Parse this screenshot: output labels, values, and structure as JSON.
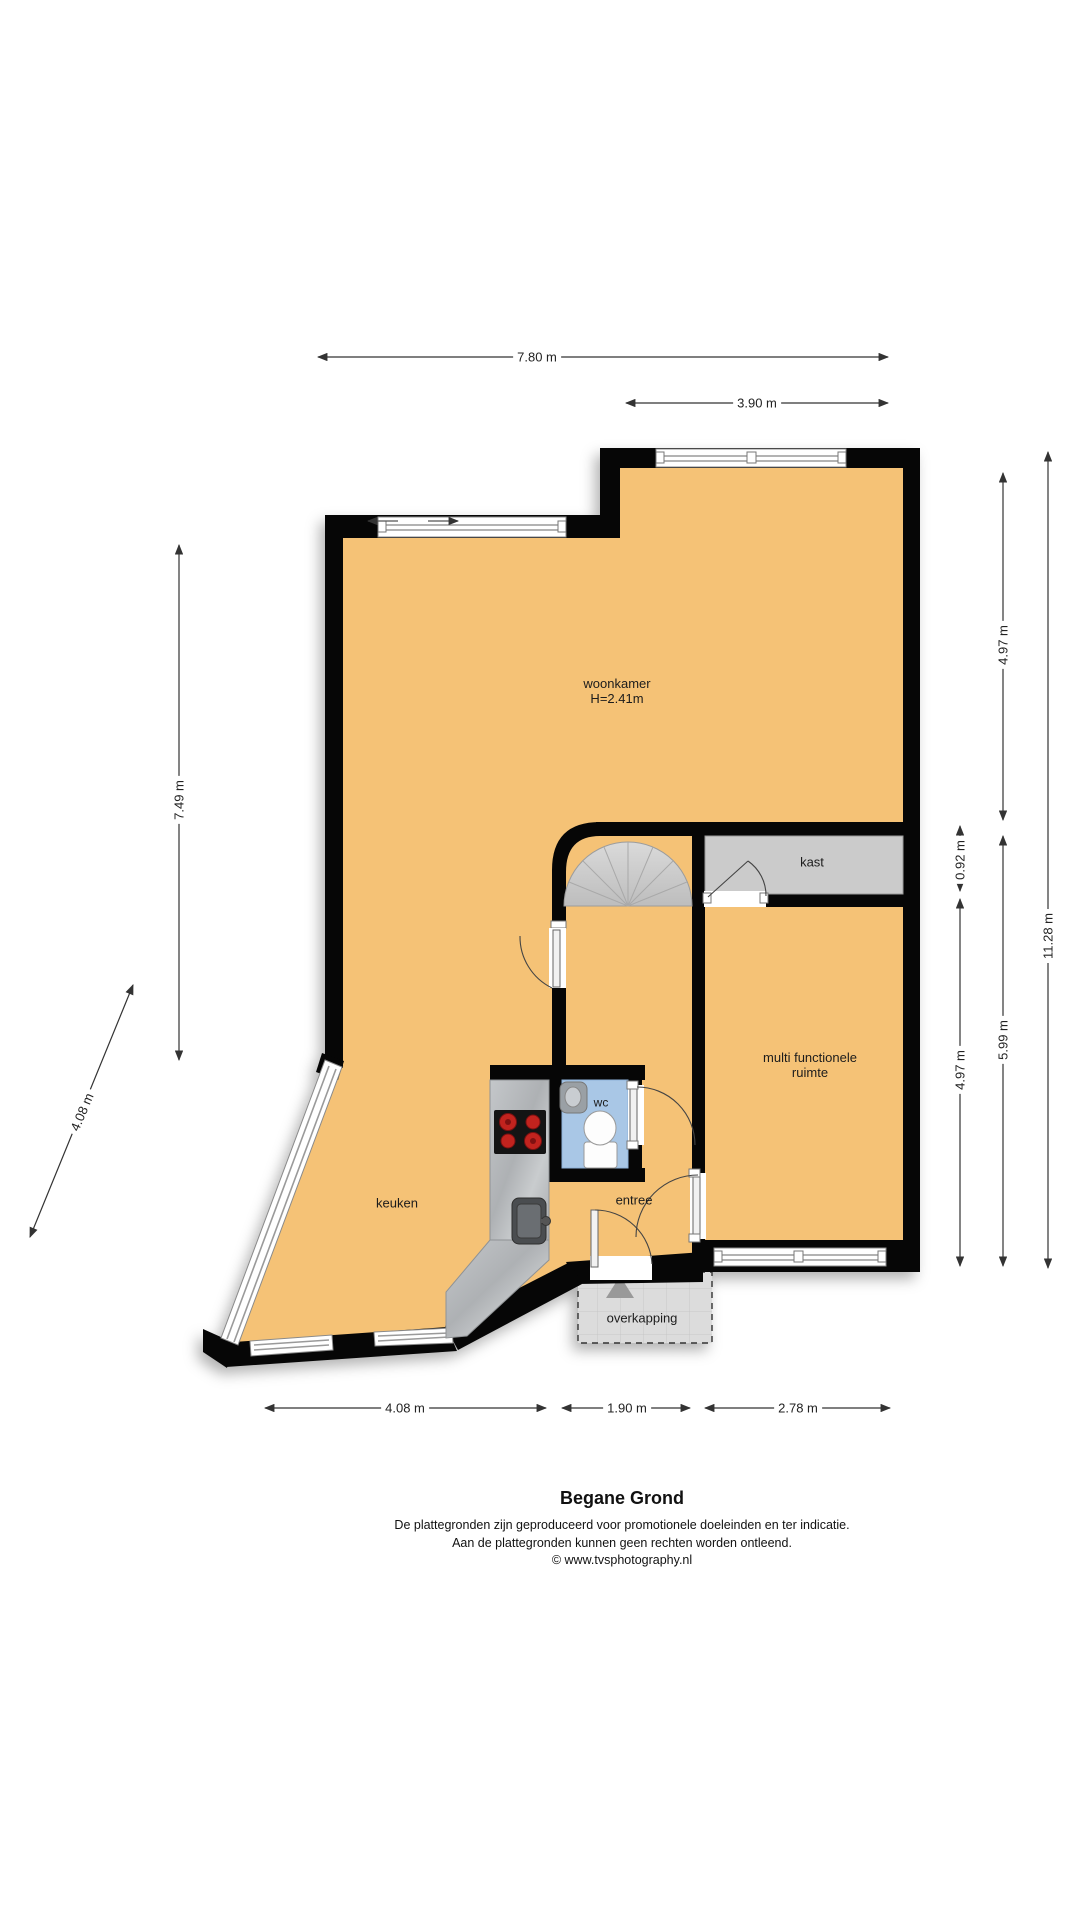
{
  "title": "Begane Grond",
  "footer": {
    "line1": "De plattegronden zijn geproduceerd voor promotionele doeleinden en ter indicatie.",
    "line2": "Aan de plattegronden kunnen geen rechten worden ontleend.",
    "line3": "© www.tvsphotography.nl"
  },
  "rooms": {
    "woonkamer": "woonkamer",
    "woonkamer_height": "H=2.41m",
    "kast": "kast",
    "mfr_line1": "multi functionele",
    "mfr_line2": "ruimte",
    "wc": "wc",
    "keuken": "keuken",
    "entree": "entree",
    "overkapping": "overkapping"
  },
  "dimensions": {
    "top_total": "7.80 m",
    "top_right": "3.90 m",
    "left_wall": "7.49 m",
    "diagonal_wall": "4.08 m",
    "right_upper": "4.97 m",
    "kast_depth": "0.92 m",
    "mfr_height": "4.97 m",
    "right_lower": "5.99 m",
    "right_total": "11.28 m",
    "bottom_left": "4.08 m",
    "bottom_middle": "1.90 m",
    "bottom_right": "2.78 m"
  },
  "colors": {
    "floor": "#F5C276",
    "wall": "#060606",
    "wc_floor": "#A9C7E6",
    "closet": "#CBCBCB",
    "stairs": "#CDCDCD",
    "counter": "#B7BABD",
    "overkapping": "#DCDCDC",
    "burner": "#C2231E",
    "dim_line": "#333333"
  }
}
